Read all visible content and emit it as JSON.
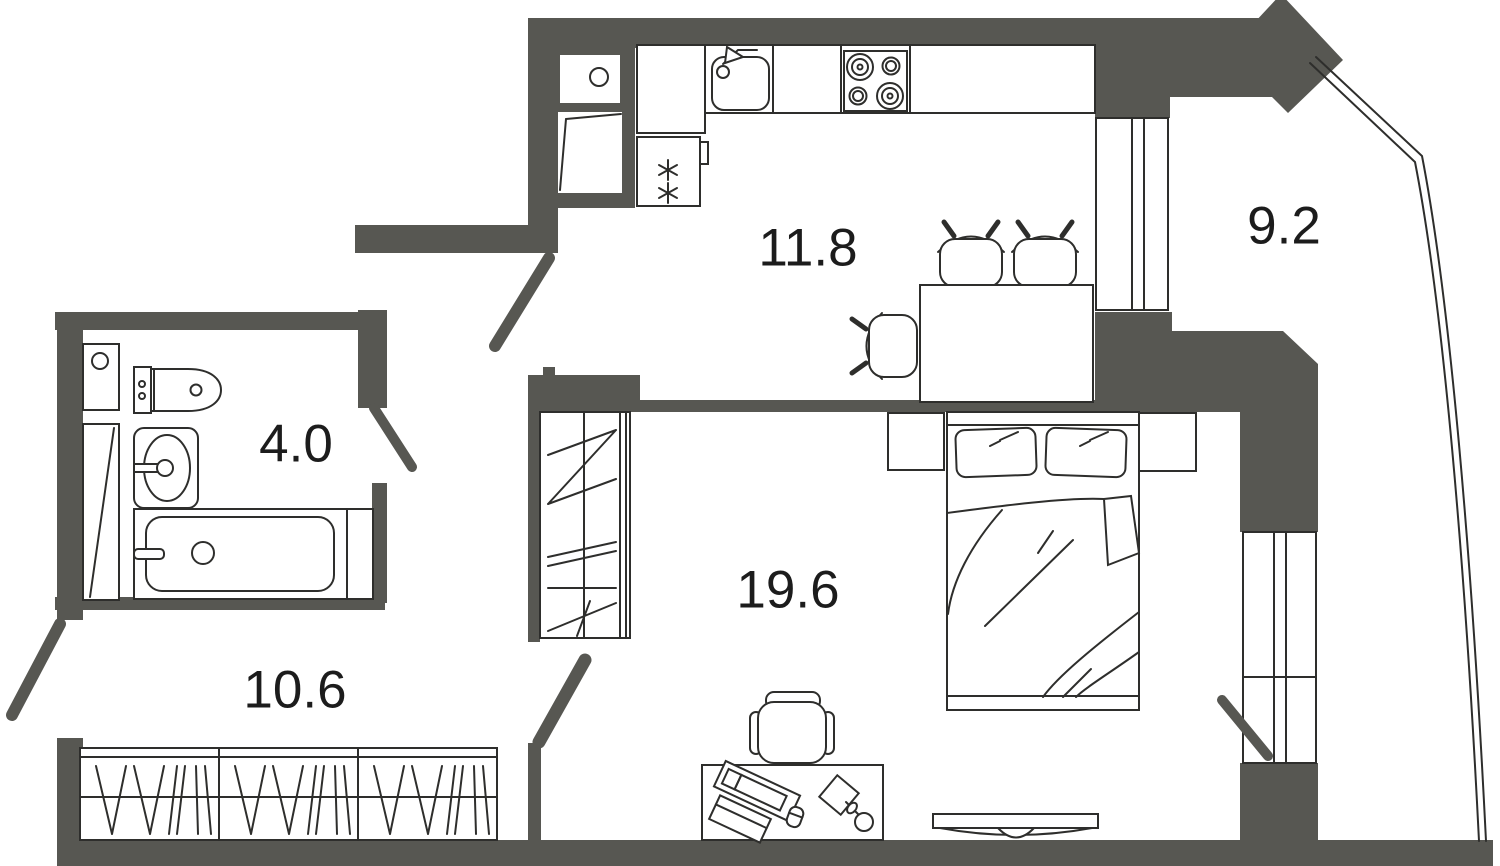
{
  "title": "Apartment floor plan",
  "colors": {
    "background": "#ffffff",
    "wall": "#575752",
    "line": "#2e2e2c",
    "text": "#1c1c1c"
  },
  "rooms": {
    "kitchen": {
      "name": "kitchen-dining",
      "area": "11.8"
    },
    "balcony": {
      "name": "balcony",
      "area": "9.2"
    },
    "bathroom": {
      "name": "bathroom",
      "area": "4.0"
    },
    "living_room": {
      "name": "living-room",
      "area": "19.6"
    },
    "hallway": {
      "name": "hallway",
      "area": "10.6"
    }
  },
  "furniture_icons": {
    "kitchen": [
      "kitchen-counter",
      "kitchen-sink-icon",
      "faucet-icon",
      "stove-icon",
      "fridge-icon",
      "dining-table",
      "dining-chair-icon"
    ],
    "living_room": [
      "wardrobe-icon",
      "bed-icon",
      "pillow-icon",
      "nightstand",
      "desk-icon",
      "monitor-icon",
      "keyboard-icon",
      "mouse-icon",
      "lamp-icon",
      "office-chair-icon",
      "tv-icon"
    ],
    "bathroom": [
      "toilet-icon",
      "washbasin-icon",
      "bathtub-icon",
      "shaft-box"
    ],
    "hallway": [
      "hall-wardrobe-icon"
    ],
    "openings": [
      "entry-door-swing",
      "kitchen-door-swing",
      "bathroom-door-swing",
      "balcony-door-swing",
      "kitchen-window",
      "living-room-window",
      "balcony-glazing"
    ]
  }
}
